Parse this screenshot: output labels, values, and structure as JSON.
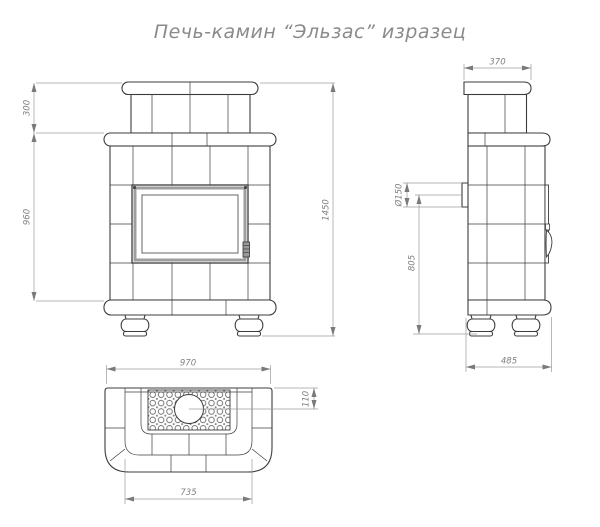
{
  "title": "Печь-камин “Эльзас” изразец",
  "drawing": {
    "front_view": {
      "dims": {
        "chimney_height": "300",
        "body_height": "960",
        "total_height": "1450"
      }
    },
    "side_view": {
      "dims": {
        "top_depth": "370",
        "flue_diameter": "Ø150",
        "flue_center_height": "805",
        "base_depth": "485"
      }
    },
    "plan_view": {
      "dims": {
        "overall_width": "970",
        "front_width": "735",
        "flue_center_offset": "110"
      }
    }
  },
  "colors": {
    "background": "#ffffff",
    "outline": "#3c3c3c",
    "dimension_line": "#9b9b9b",
    "dimension_text": "#808080",
    "title_text": "#8a8a8a",
    "door_frame_band": "#9e9e9e"
  }
}
